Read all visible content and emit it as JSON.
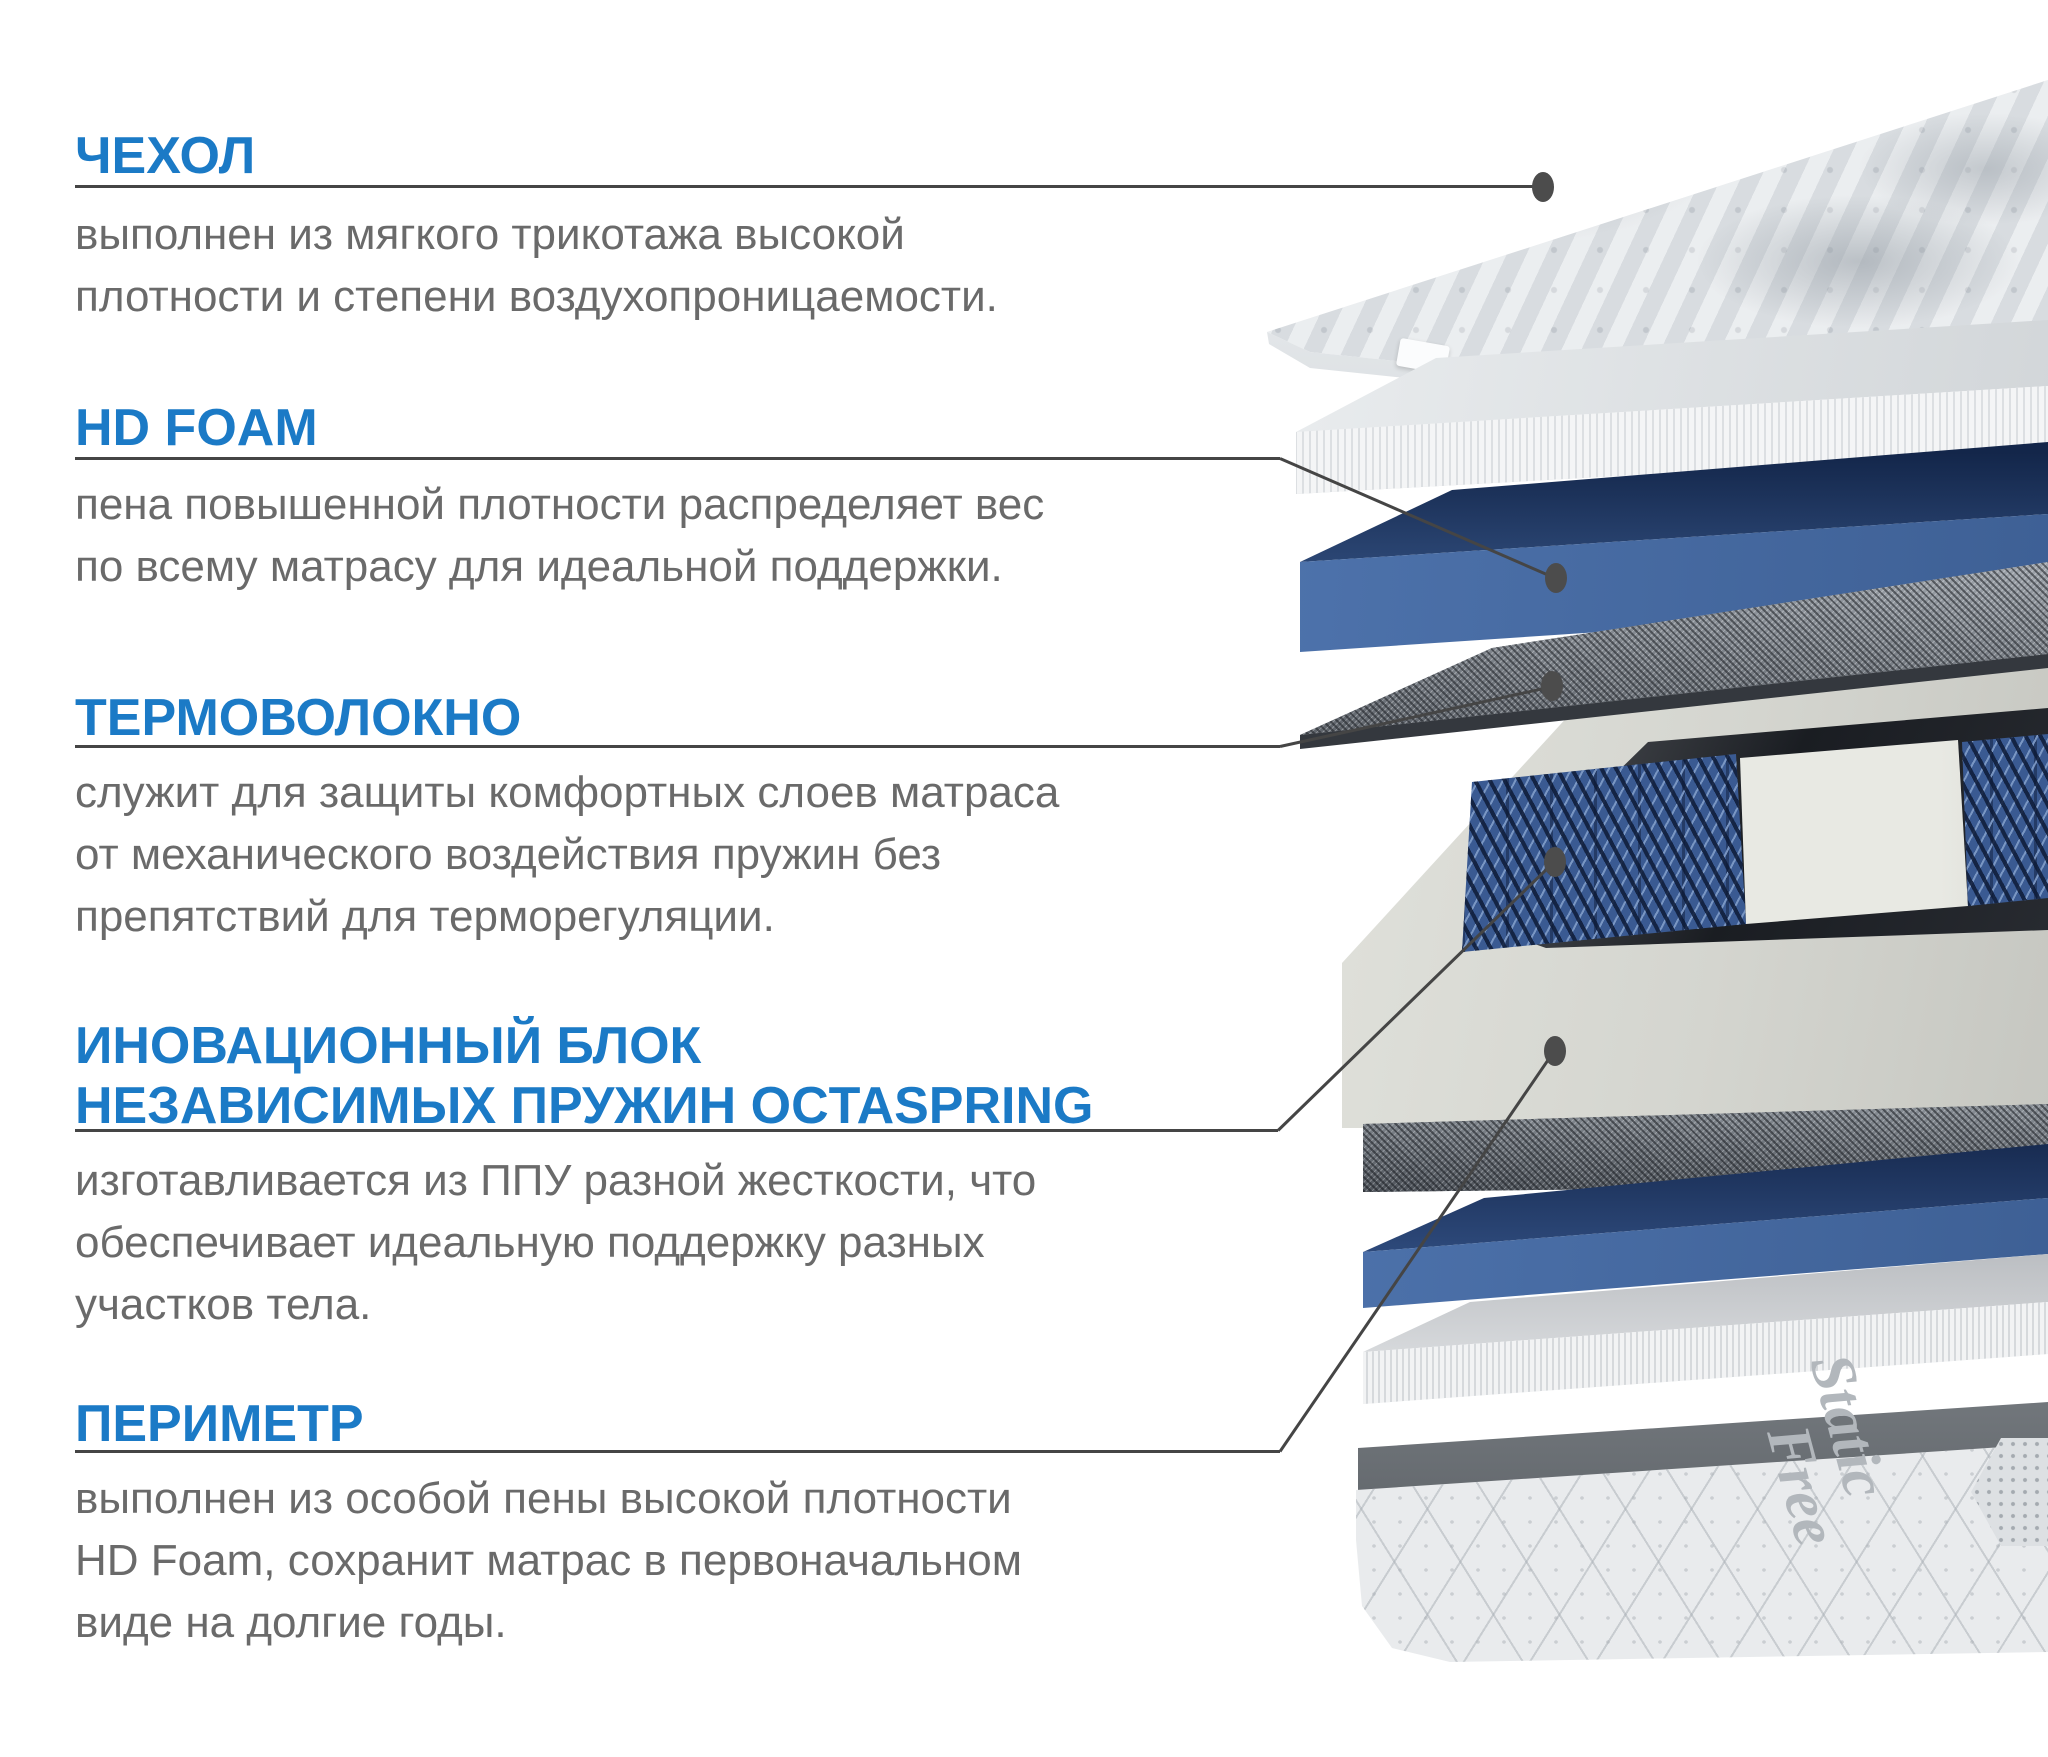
{
  "colors": {
    "accent_blue": "#1b7ac6",
    "body_text": "#6a6a6a",
    "leader_line": "#454545",
    "foam_blue": "#4a6fa8",
    "felt_gray": "#8a9097",
    "frame_white": "#d6d7d1"
  },
  "sections": [
    {
      "title": "ЧЕХОЛ",
      "lines": [
        "выполнен из мягкого трикотажа высокой",
        "плотности и степени воздухопроницаемости."
      ]
    },
    {
      "title": "HD FOAM",
      "lines": [
        "пена повышенной плотности распределяет вес",
        "по всему матрасу для идеальной поддержки."
      ]
    },
    {
      "title": "ТЕРМОВОЛОКНО",
      "lines": [
        "служит для защиты комфортных слоев матраса",
        "от механического воздействия пружин без",
        "препятствий для терморегуляции."
      ]
    },
    {
      "title": "ИНОВАЦИОННЫЙ БЛОК",
      "title2": "НЕЗАВИСИМЫХ ПРУЖИН OCTASPRING",
      "lines": [
        "изготавливается из ППУ разной жесткости, что",
        "обеспечивает идеальную поддержку разных",
        "участков тела."
      ]
    },
    {
      "title": "ПЕРИМЕТР",
      "lines": [
        "выполнен из особой пены высокой плотности",
        "HD Foam, сохранит матрас в первоначальном",
        "виде на долгие годы."
      ]
    }
  ],
  "illustration": {
    "fabric_print_line1": "Static",
    "fabric_print_line2": "Free"
  }
}
